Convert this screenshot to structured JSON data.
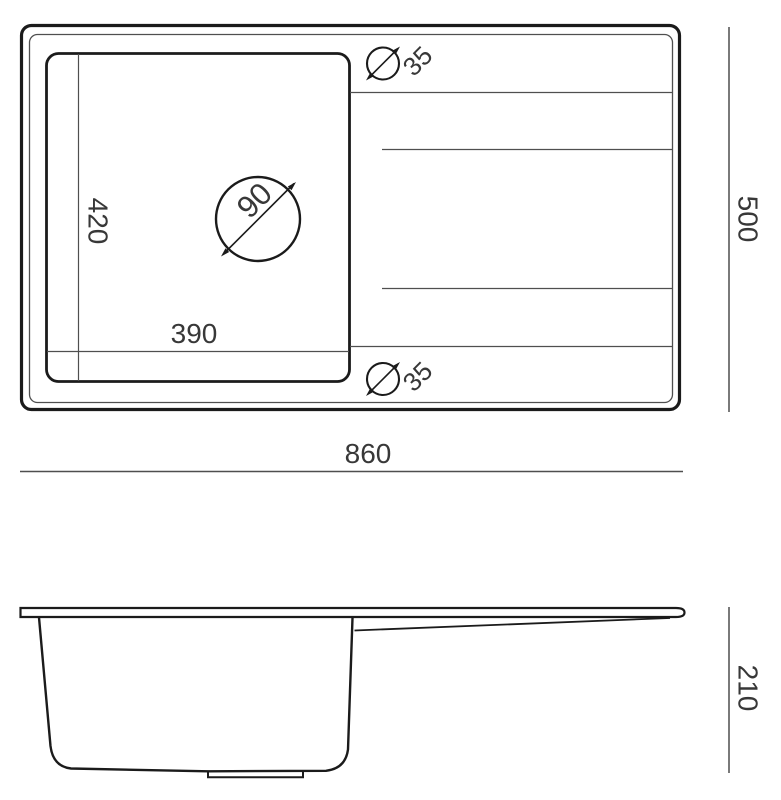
{
  "drawing": {
    "type": "sink-technical-drawing",
    "views": [
      "top-view",
      "side-view"
    ]
  },
  "dims": {
    "overall_width": "860",
    "overall_depth": "500",
    "bowl_width": "390",
    "bowl_depth": "420",
    "faucet_hole_diameter": "90",
    "tap_hole_top_diameter": "35",
    "tap_hole_bottom_diameter": "35",
    "side_height": "210"
  },
  "colors": {
    "line_primary": "#1b1b1b",
    "line_secondary": "#4f4f4f",
    "label_text": "#383838",
    "background": "#ffffff"
  }
}
